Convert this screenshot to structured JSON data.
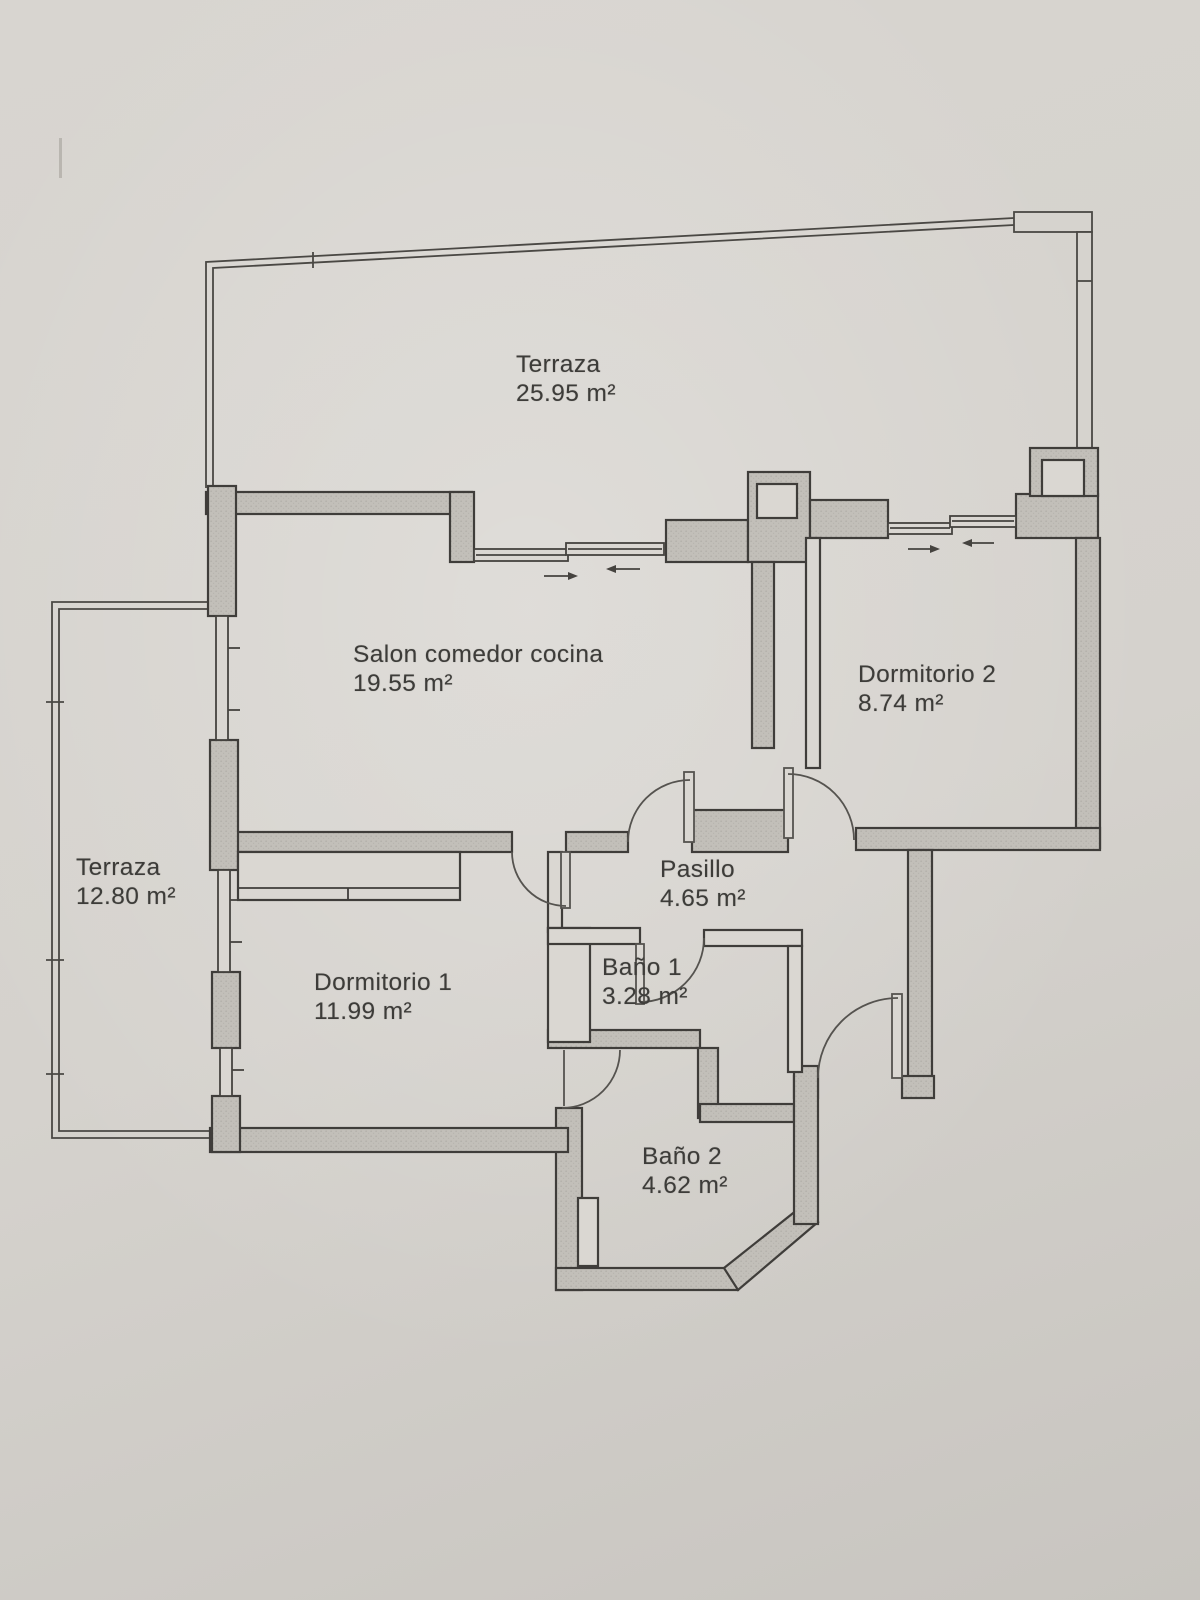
{
  "document": {
    "kind": "apartment floor plan",
    "total_labeled_rooms": 8
  },
  "rooms": {
    "terraza_principal": {
      "name": "Terraza",
      "area": "25.95 m²"
    },
    "salon": {
      "name": "Salon comedor cocina",
      "area": "19.55 m²"
    },
    "dormitorio2": {
      "name": "Dormitorio 2",
      "area": "8.74 m²"
    },
    "terraza_lateral": {
      "name": "Terraza",
      "area": "12.80 m²"
    },
    "pasillo": {
      "name": "Pasillo",
      "area": "4.65 m²"
    },
    "dormitorio1": {
      "name": "Dormitorio 1",
      "area": "11.99 m²"
    },
    "bano1": {
      "name": "Baño 1",
      "area": "3.28 m²"
    },
    "bano2": {
      "name": "Baño 2",
      "area": "4.62 m²"
    }
  },
  "colors": {
    "paper": "#d6d3ce",
    "wall_fill": "#c2bfb9",
    "wall_outline": "#3f3d3a",
    "thin_line": "#504e4a",
    "text": "#3d3c39"
  }
}
